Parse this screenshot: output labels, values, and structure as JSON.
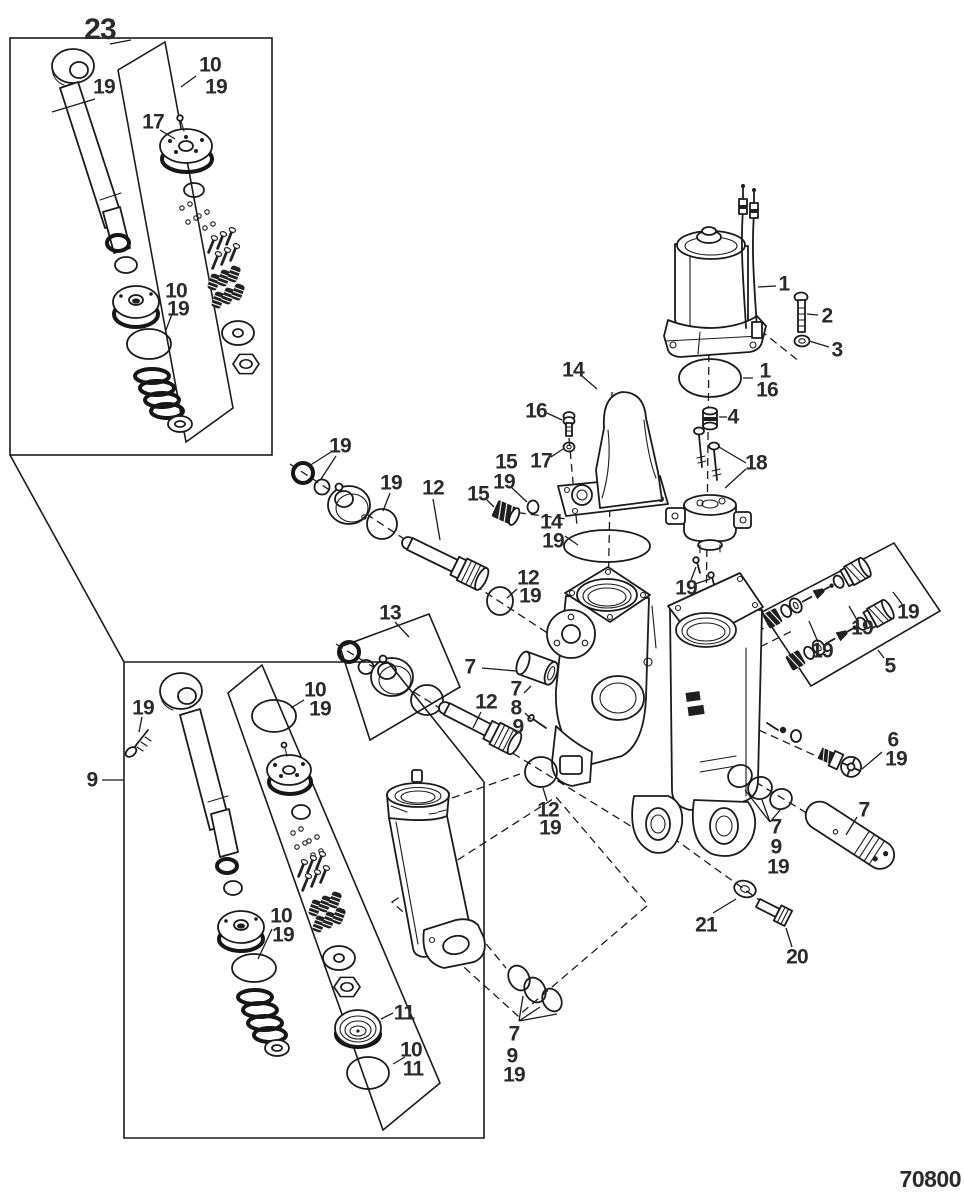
{
  "diagram": {
    "number": "70800",
    "kind": "exploded-parts-diagram",
    "background": "#ffffff",
    "ink_color": "#1b1b1b",
    "label_color": "#2b2b2b"
  },
  "callouts": [
    {
      "part": "23",
      "x": 100,
      "y": 30,
      "fs": 30
    },
    {
      "part": "19",
      "x": 104,
      "y": 87
    },
    {
      "part": "10",
      "x": 210,
      "y": 65
    },
    {
      "part": "19",
      "x": 216,
      "y": 87
    },
    {
      "part": "17",
      "x": 153,
      "y": 122
    },
    {
      "part": "10",
      "x": 176,
      "y": 291
    },
    {
      "part": "19",
      "x": 178,
      "y": 309
    },
    {
      "part": "1",
      "x": 784,
      "y": 284
    },
    {
      "part": "2",
      "x": 827,
      "y": 316
    },
    {
      "part": "3",
      "x": 837,
      "y": 350
    },
    {
      "part": "1",
      "x": 765,
      "y": 371
    },
    {
      "part": "16",
      "x": 767,
      "y": 390
    },
    {
      "part": "14",
      "x": 573,
      "y": 370
    },
    {
      "part": "16",
      "x": 536,
      "y": 411
    },
    {
      "part": "17",
      "x": 541,
      "y": 461
    },
    {
      "part": "15",
      "x": 506,
      "y": 462
    },
    {
      "part": "19",
      "x": 504,
      "y": 482
    },
    {
      "part": "15",
      "x": 478,
      "y": 494
    },
    {
      "part": "14",
      "x": 551,
      "y": 522
    },
    {
      "part": "19",
      "x": 553,
      "y": 541
    },
    {
      "part": "4",
      "x": 733,
      "y": 417
    },
    {
      "part": "18",
      "x": 756,
      "y": 463
    },
    {
      "part": "19",
      "x": 686,
      "y": 588
    },
    {
      "part": "19",
      "x": 822,
      "y": 651
    },
    {
      "part": "19",
      "x": 862,
      "y": 628
    },
    {
      "part": "19",
      "x": 908,
      "y": 612
    },
    {
      "part": "5",
      "x": 890,
      "y": 666
    },
    {
      "part": "6",
      "x": 893,
      "y": 740
    },
    {
      "part": "19",
      "x": 896,
      "y": 759
    },
    {
      "part": "7",
      "x": 864,
      "y": 810
    },
    {
      "part": "7",
      "x": 776,
      "y": 827
    },
    {
      "part": "9",
      "x": 776,
      "y": 847
    },
    {
      "part": "19",
      "x": 778,
      "y": 867
    },
    {
      "part": "21",
      "x": 706,
      "y": 925
    },
    {
      "part": "20",
      "x": 797,
      "y": 957
    },
    {
      "part": "19",
      "x": 340,
      "y": 446
    },
    {
      "part": "19",
      "x": 391,
      "y": 483
    },
    {
      "part": "12",
      "x": 433,
      "y": 488
    },
    {
      "part": "12",
      "x": 528,
      "y": 578
    },
    {
      "part": "19",
      "x": 530,
      "y": 596
    },
    {
      "part": "13",
      "x": 390,
      "y": 613
    },
    {
      "part": "7",
      "x": 470,
      "y": 667
    },
    {
      "part": "7",
      "x": 516,
      "y": 689
    },
    {
      "part": "8",
      "x": 516,
      "y": 708
    },
    {
      "part": "9",
      "x": 518,
      "y": 727
    },
    {
      "part": "12",
      "x": 486,
      "y": 702
    },
    {
      "part": "12",
      "x": 548,
      "y": 810
    },
    {
      "part": "19",
      "x": 550,
      "y": 828
    },
    {
      "part": "9",
      "x": 92,
      "y": 780
    },
    {
      "part": "19",
      "x": 143,
      "y": 708
    },
    {
      "part": "10",
      "x": 315,
      "y": 690
    },
    {
      "part": "19",
      "x": 320,
      "y": 709
    },
    {
      "part": "10",
      "x": 281,
      "y": 916
    },
    {
      "part": "19",
      "x": 283,
      "y": 935
    },
    {
      "part": "11",
      "x": 404,
      "y": 1013
    },
    {
      "part": "10",
      "x": 411,
      "y": 1050
    },
    {
      "part": "11",
      "x": 413,
      "y": 1069
    },
    {
      "part": "7",
      "x": 514,
      "y": 1034
    },
    {
      "part": "9",
      "x": 512,
      "y": 1056
    },
    {
      "part": "19",
      "x": 514,
      "y": 1075
    }
  ]
}
